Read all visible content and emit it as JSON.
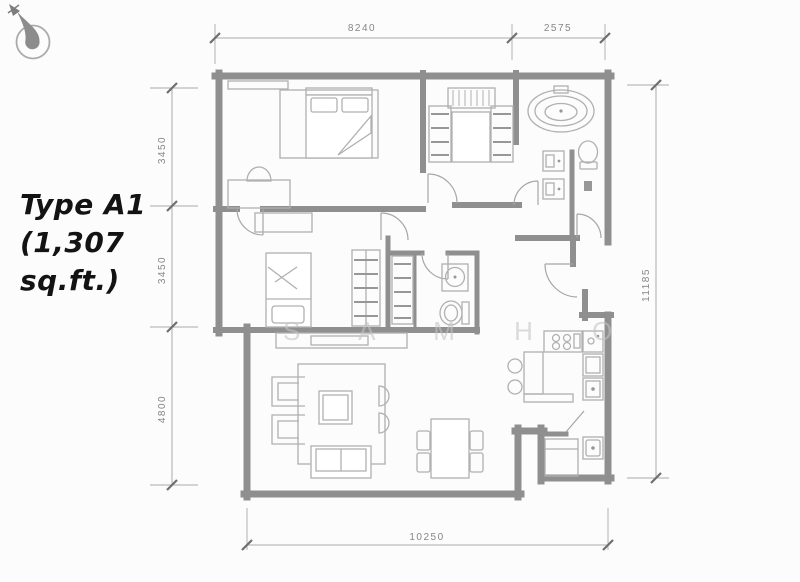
{
  "title": {
    "lines": [
      "Type A1",
      "(1,307",
      "sq.ft.)"
    ]
  },
  "dimensions": {
    "top_main": "8240",
    "top_right": "2575",
    "left_upper": "3450",
    "left_middle": "3450",
    "left_lower": "4800",
    "right_total": "11185",
    "bottom_total": "10250"
  },
  "watermark": {
    "text": "SAMHO",
    "display": "S A M H O"
  },
  "icons": {
    "compass": "north-arrow-icon"
  },
  "colors": {
    "background": "#fcfcfc",
    "wall": "#8f8f8f",
    "furniture": "#b0b0b0",
    "furniture_dark": "#979797",
    "door": "#a6a6a6",
    "dimension": "#aaaaaa",
    "dim_text": "#868686",
    "title_text": "#131313",
    "watermark": "#c4c4c4"
  }
}
